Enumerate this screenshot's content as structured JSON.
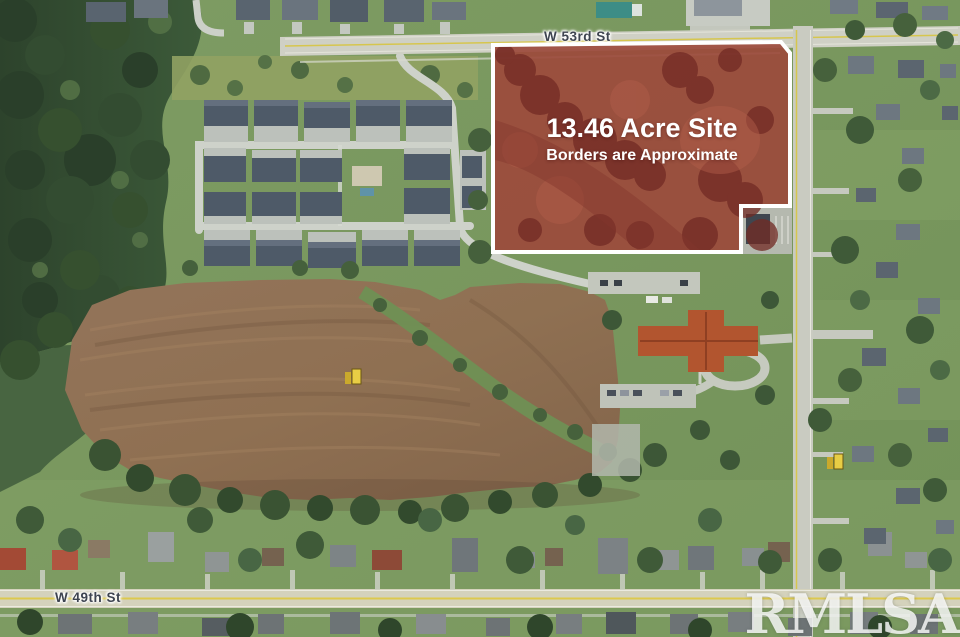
{
  "listing": {
    "site_overlay": {
      "title": "13.46 Acre Site",
      "subtitle": "Borders are Approximate",
      "parcel_fill": "#9C4A3C",
      "parcel_border": "#FFFFFF"
    },
    "streets": {
      "north": "W 53rd St",
      "south": "W 49th St"
    },
    "watermark": "RMLSA",
    "colors": {
      "grass": "#7C9A60",
      "forest": "#31472F",
      "plowed_field": "#8F7052",
      "road": "#CFD0C5",
      "road_marking_yellow": "#D6C64E",
      "church_roof": "#B2552F",
      "equipment_marker": "#E8CD45"
    }
  }
}
